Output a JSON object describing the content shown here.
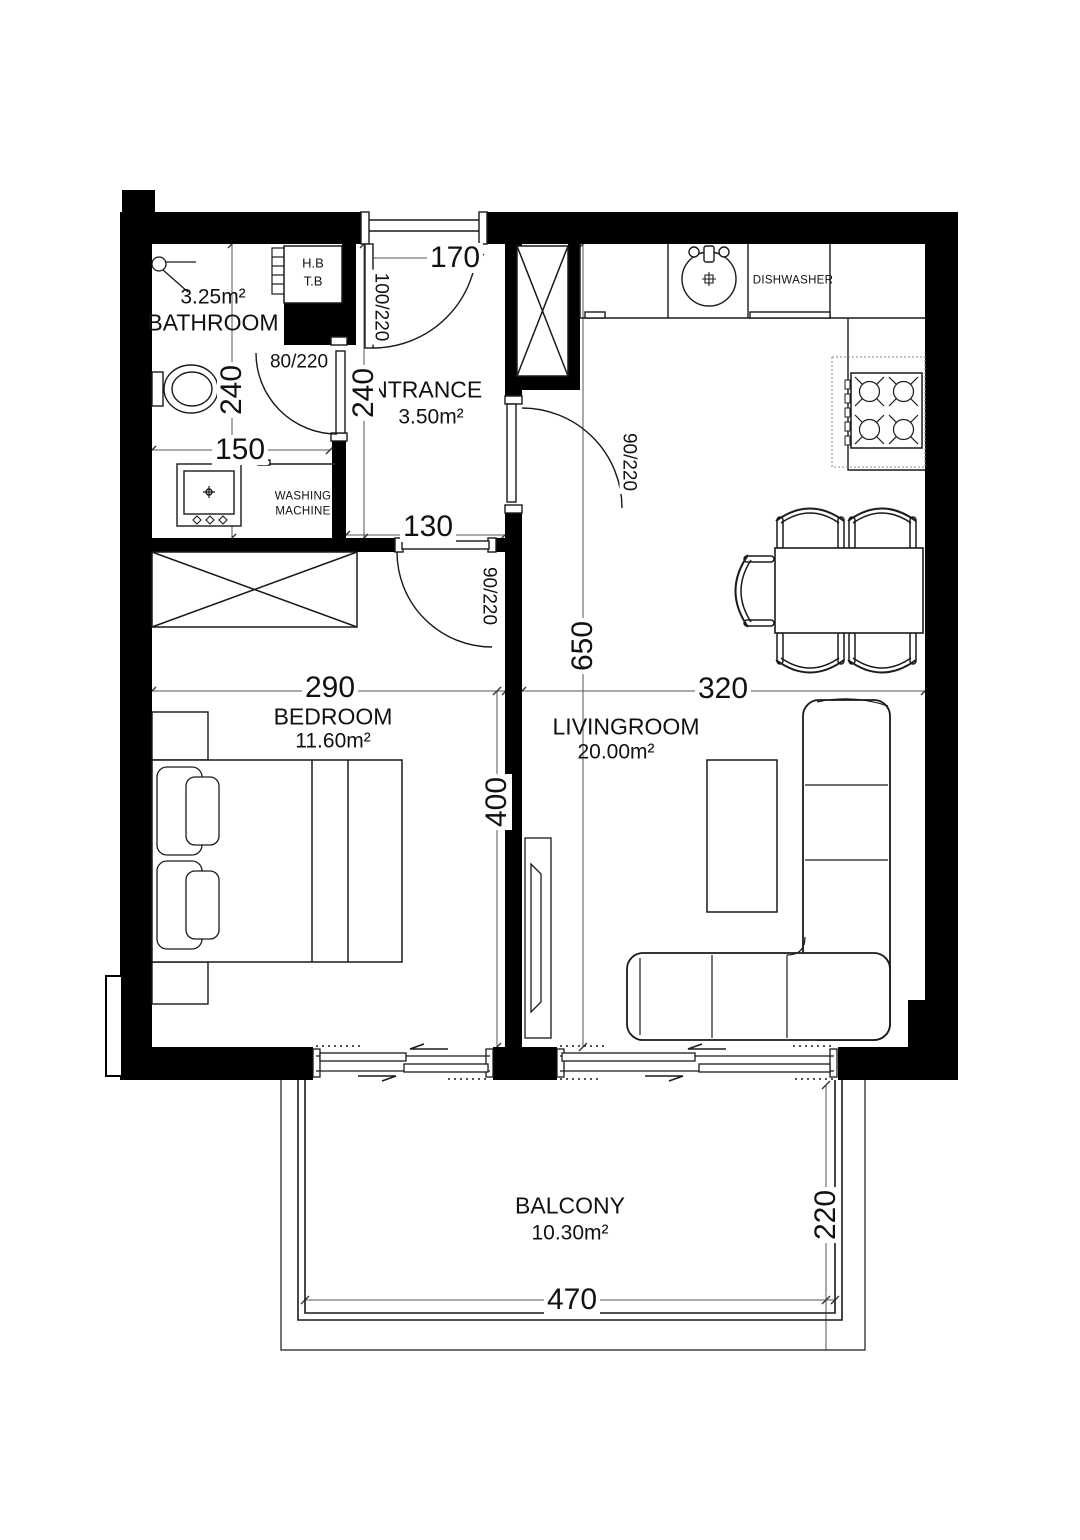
{
  "rooms": {
    "bathroom": {
      "name": "BATHROOM",
      "area": "3.25m²"
    },
    "entrance": {
      "name": "ENTRANCE",
      "area": "3.50m²"
    },
    "bedroom": {
      "name": "BEDROOM",
      "area": "11.60m²"
    },
    "livingroom": {
      "name": "LIVINGROOM",
      "area": "20.00m²"
    },
    "balcony": {
      "name": "BALCONY",
      "area": "10.30m²"
    }
  },
  "dimensions_cm": {
    "entrance_top_width": "170",
    "bathroom_depth": "240",
    "entrance_depth": "240",
    "bathroom_width": "150",
    "corridor_width": "130",
    "bedroom_width": "290",
    "bedroom_depth": "400",
    "livingroom_width": "320",
    "livingroom_depth": "650",
    "balcony_width": "470",
    "balcony_depth": "220"
  },
  "doors": {
    "entrance": "100/220",
    "bathroom": "80/220",
    "livingroom": "90/220",
    "bedroom": "90/220"
  },
  "labels": {
    "dishwasher": "DISHWASHER",
    "washing_machine_line1": "WASHING",
    "washing_machine_line2": "MACHINE",
    "closet_line1": "H.B",
    "closet_line2": "T.B"
  },
  "colors": {
    "wall": "#000000",
    "line": "#1a1a1a",
    "dim_line": "#555555",
    "background": "#ffffff"
  }
}
